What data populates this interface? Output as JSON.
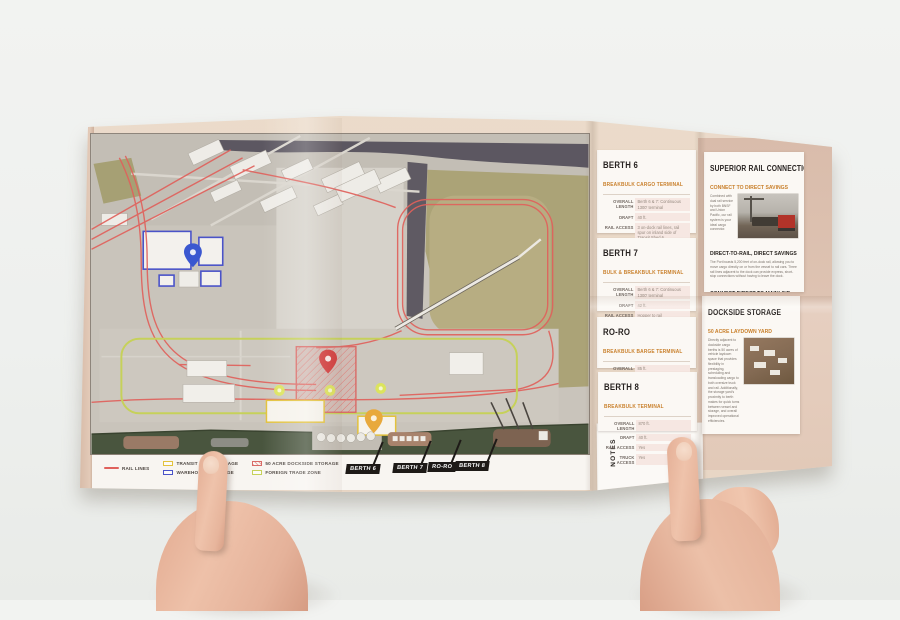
{
  "colors": {
    "brochure_beige": "#e9d8c7",
    "panel_pink_tan": "#dcc0af",
    "card_white": "#fbf8f4",
    "header_black": "#272220",
    "accent_orange": "#c9802c",
    "rail_red": "#e0615c",
    "ftz_green_yellow": "#c6d15a",
    "warehouse_blue": "#4a53c8",
    "transit_shed_yellow": "#e3c23c",
    "dockside_storage_red": "#d96a66",
    "water_green": "#49553e",
    "river_dark": "#5c5761"
  },
  "legend": {
    "items": [
      {
        "label": "RAIL LINES",
        "swatch": "rail-line-swatch",
        "color": "#e0615c"
      },
      {
        "label": "TRANSIT SHED STORAGE",
        "swatch": "outline-box-swatch",
        "color": "#e3c23c"
      },
      {
        "label": "WAREHOUSE STORAGE",
        "swatch": "outline-box-swatch",
        "color": "#4a53c8"
      },
      {
        "label": "50 ACRE DOCKSIDE STORAGE",
        "swatch": "hatched-box-swatch",
        "color": "#d96a66"
      },
      {
        "label": "FOREIGN TRADE ZONE",
        "swatch": "outline-box-swatch",
        "color": "#c6d15a"
      }
    ]
  },
  "flags": {
    "berth6": "BERTH 6",
    "berth7": "BERTH 7",
    "roro": "RO-RO",
    "berth8": "BERTH 8"
  },
  "notes_label": "NOTES",
  "cards": [
    {
      "title": "BERTH 6",
      "subtitle": "BREAKBULK CARGO TERMINAL",
      "rows": [
        {
          "label": "OVERALL LENGTH",
          "value": "Berth 6 & 7: Continuous 1300' terminal"
        },
        {
          "label": "DRAFT",
          "value": "40 ft."
        },
        {
          "label": "RAIL ACCESS",
          "value": "3 on-dock rail lines, rail spur on inland side of Transit Shed 6"
        },
        {
          "label": "TRUCK ACCESS",
          "value": "Yes"
        },
        {
          "label": "STORAGE",
          "value": "On-dock transit shed"
        }
      ]
    },
    {
      "title": "BERTH 7",
      "subtitle": "BULK & BREAKBULK TERMINAL",
      "rows": [
        {
          "label": "OVERALL LENGTH",
          "value": "Berth 6 & 7: Continuous 1300' terminal"
        },
        {
          "label": "DRAFT",
          "value": "42 ft."
        },
        {
          "label": "RAIL ACCESS",
          "value": "Hopper to rail"
        },
        {
          "label": "TRUCK ACCESS",
          "value": "Hopper to truck"
        },
        {
          "label": "STORAGE",
          "value": "Hopper to storage"
        }
      ]
    },
    {
      "title": "RO-RO",
      "subtitle": "BREAKBULK BARGE TERMINAL",
      "rows": [
        {
          "label": "OVERALL LENGTH",
          "value": "85 ft."
        },
        {
          "label": "DRAFT",
          "value": "42 ft."
        },
        {
          "label": "RAIL ACCESS",
          "value": "No"
        },
        {
          "label": "TRUCK ACCESS",
          "value": "Yes"
        }
      ]
    },
    {
      "title": "BERTH 8",
      "subtitle": "BREAKBULK TERMINAL",
      "rows": [
        {
          "label": "OVERALL LENGTH",
          "value": "870 ft."
        },
        {
          "label": "DRAFT",
          "value": "40 ft."
        },
        {
          "label": "RAIL ACCESS",
          "value": "Yes"
        },
        {
          "label": "TRUCK ACCESS",
          "value": "Yes"
        }
      ]
    }
  ],
  "rail_panel": {
    "title": "SUPERIOR RAIL CONNECTIONS",
    "subtitle": "CONNECT TO DIRECT SAVINGS",
    "intro": "Combined with dual rail service by both BNSF and Union Pacific, our rail system is your ideal cargo connector.",
    "photo_name": "train-at-dock-photo",
    "section1_heading": "DIRECT-TO-RAIL, DIRECT SAVINGS",
    "section1_body": "The Port boasts 5,200 feet of on-dock rail, allowing you to move cargo directly on or from the vessel to rail cars. Three rail lines adjacent to the dock can provide express, short-stop connections without having to leave the dock.",
    "section2_heading": "CONNECT DIRECT TO MAINLINE",
    "section2_body": "Over 15 miles of internal rail connect all corners of the Port with BNSF and Union Pacific Class I mainline systems. The Port's private switch line keeps your cargo moving with mainline connections, without distraction, and provides superior service to rail-dependent customers."
  },
  "storage_panel": {
    "title": "DOCKSIDE STORAGE",
    "subtitle": "50 ACRE LAYDOWN YARD",
    "intro": "Directly adjacent to dockside cargo berths is 50 acres of vehicle laydown space that provides flexibility in prestaging, scheduling and transloading cargo to both oversize truck and rail. Additionally, the storage yard's proximity to berth makes for quick turns between vessel and storage, and overall improved operational efficiencies.",
    "photo_name": "laydown-yard-aerial-photo",
    "section1_heading": "FOREIGN TRADE ZONE",
    "section1_body": "Boost your bottom line via the Port's general purpose Foreign Trade Zone. Performing standard operating activities inside the bounds of the Port's FTZ can keep fees in deferred and reduced status. Both dockside open storage and warehouse options available.",
    "section2_heading": "WAREHOUSING",
    "section2_body": "Both on-dock transit sheds and industrial warehousing storage are available.",
    "photo2_name": "warehouse-aerial-photo"
  },
  "map": {
    "name": "port-terminal-satellite-map",
    "markers": [
      {
        "name": "warehouse-pin",
        "color": "#3a57d0"
      },
      {
        "name": "dockside-storage-pin",
        "color": "#d23c3c"
      },
      {
        "name": "transit-shed-pin",
        "color": "#e8a93c"
      },
      {
        "name": "yard-dot-markers",
        "color": "#dde655"
      }
    ]
  }
}
